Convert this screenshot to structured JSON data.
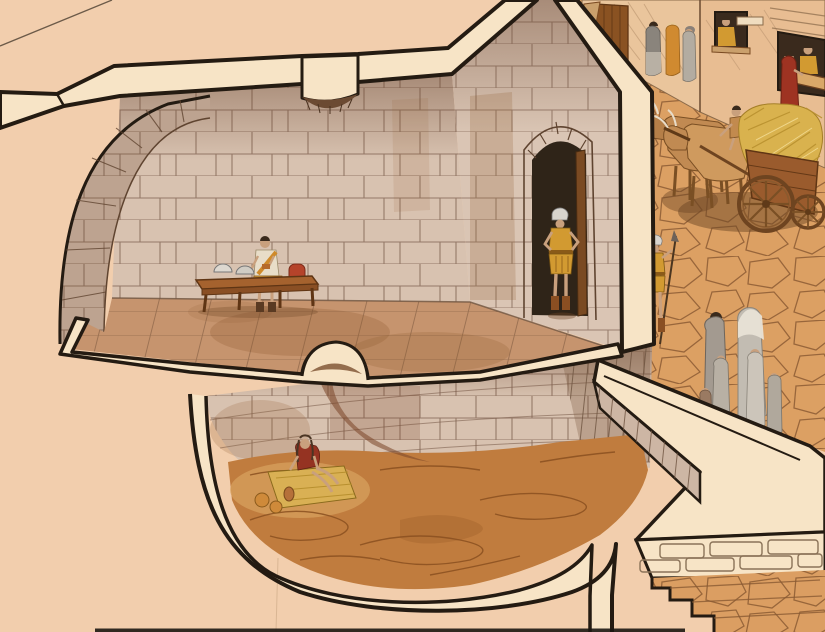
{
  "meta": {
    "type": "illustration",
    "subject": "Ink-and-watercolor cutaway reconstruction of an ancient Roman prison: a barrel-vaulted guard room with a bench and soldiers above, a round pit cell with a lone prisoner below, and a cobbled street outside with an ox cart, a spear guard, shops and passers-by",
    "style": "architectural cutaway watercolor",
    "canvas": {
      "width": 825,
      "height": 632
    }
  },
  "palette": {
    "paper": "#f2cead",
    "cut": "#f7e4c6",
    "ink": "#241b12",
    "stone": "#d8c2b0",
    "stone-line": "#7d5f4e",
    "stain": "#8f5a2e",
    "floor": "#c6946e",
    "floor-line": "#8a6448",
    "dirt": "#c07c3e",
    "dirt-line": "#8a5020",
    "cobble": "#e3a668",
    "cobble-line": "#8a5a33",
    "shadow": "#6e4726",
    "wood": "#9a5b2d",
    "wood-dark": "#5f3514",
    "hay": "#d9b24e",
    "tunic": "#d29a31",
    "red": "#9e3322",
    "gray-robe": "#b3aca1",
    "orange-robe": "#d08a30",
    "skin": "#c9a07d",
    "helmet": "#d8d4cd",
    "ox": "#c18a52",
    "building": "#eac59c",
    "opening": "#3a2a1d"
  },
  "scene": {
    "areas": [
      {
        "id": "guard-room",
        "label": "vaulted guard room with stone block walls and tiled floor"
      },
      {
        "id": "pit-cell",
        "label": "round underground pit cell with earthen floor"
      },
      {
        "id": "street",
        "label": "cobbled street with buildings and shops"
      },
      {
        "id": "staircase",
        "label": "stone stairway descending at lower right"
      }
    ],
    "figures": [
      {
        "id": "bench-guard",
        "label": "soldier seated on wooden bench"
      },
      {
        "id": "door-guard",
        "label": "soldier standing in arched doorway"
      },
      {
        "id": "street-guard",
        "label": "soldier with spear outside the wall"
      },
      {
        "id": "prisoner",
        "label": "prisoner seated on straw mat in the pit"
      },
      {
        "id": "cart-driver",
        "label": "driver of the ox cart"
      },
      {
        "id": "family-group",
        "label": "family of six seen from behind on the street"
      },
      {
        "id": "townsfolk",
        "label": "robed passers-by near the doorways"
      },
      {
        "id": "window-onlooker",
        "label": "figure leaning from a window"
      },
      {
        "id": "shopkeeper",
        "label": "shopkeeper behind a counter"
      },
      {
        "id": "customer",
        "label": "red-robed customer at the shop"
      }
    ],
    "objects": [
      {
        "id": "bench",
        "label": "wooden bench with two helmets and a red satchel"
      },
      {
        "id": "ox-cart",
        "label": "two oxen pulling a wooden cart loaded with hay"
      },
      {
        "id": "vault-opening",
        "label": "opening in the vault ceiling"
      },
      {
        "id": "floor-hatch",
        "label": "hole in the floor leading to the pit"
      },
      {
        "id": "mat-and-bowls",
        "label": "straw mat with bowls and a jug"
      }
    ]
  }
}
